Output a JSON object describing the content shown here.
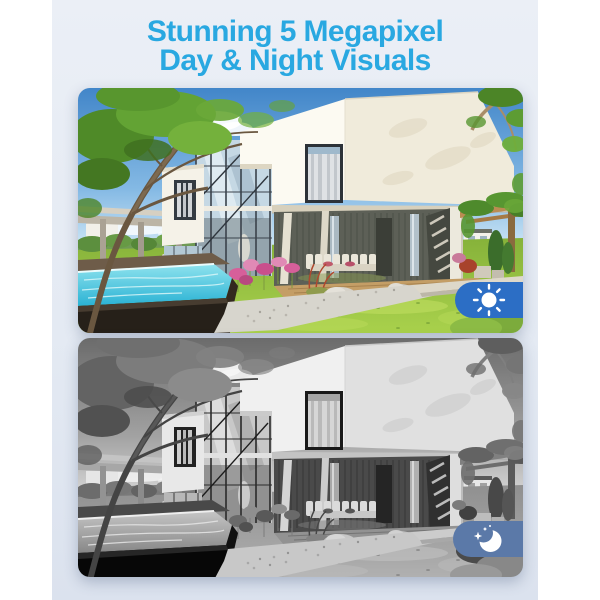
{
  "page": {
    "outer_background": "#ffffff",
    "canvas_background_top": "#ebeff6",
    "canvas_background_bottom": "#dbe2ee"
  },
  "title": {
    "line1": "Stunning 5 Megapixel",
    "line2": "Day & Night Visuals",
    "color": "#29a8e1"
  },
  "panels": [
    {
      "name": "day",
      "image_style": "full-color",
      "description": "Color daytime view of a modern two-story house with pool, lawn and garden",
      "icon": "sun-icon",
      "badge_color": "#2c6ec5"
    },
    {
      "name": "night",
      "image_style": "grayscale",
      "description": "Black-and-white night view of the same modern house",
      "icon": "moon-icon",
      "badge_color": "#5b79a8"
    }
  ]
}
